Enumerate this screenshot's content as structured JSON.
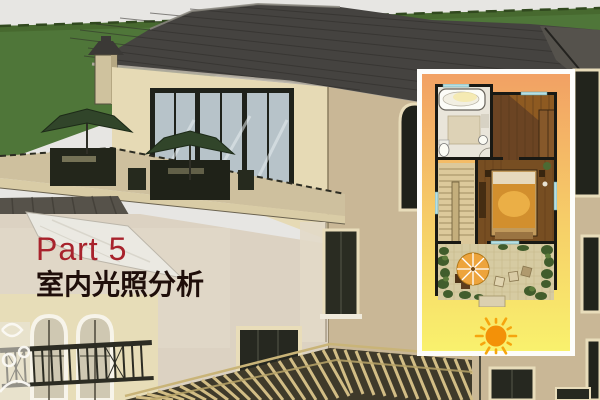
{
  "slide": {
    "part_label": "Part 5",
    "title": "室内光照分析"
  },
  "scene": {
    "description": "3D sketch rendering of a villa exterior",
    "elements": [
      "hillside",
      "hip-roof",
      "chimney",
      "roof-terrace",
      "patio-umbrellas",
      "glass-doors",
      "arched-windows",
      "balcony-railing",
      "pergola"
    ]
  },
  "inset_panel": {
    "content": "floor-plan",
    "rooms": [
      "bathroom",
      "bedroom",
      "staircase",
      "roof-terrace"
    ],
    "icons": [
      "sun-icon",
      "parasol-icon",
      "bathtub-icon",
      "bed-icon"
    ],
    "has_pointer_line": true
  },
  "colors": {
    "accent_red": "#a8222c",
    "title_dark": "#1f0e0a",
    "panel_border": "#fdfdfb",
    "panel_top": "#f2a164",
    "panel_mid": "#f6cf68",
    "panel_bottom": "#f9f16d",
    "sun": "#f39108",
    "sun_ray": "#f6a50e",
    "pointer": "#4f4c3e",
    "hill_green": "#4f7639",
    "roof_gray": "#454340",
    "wall_cream": "#e6dab5",
    "wall_tan": "#c9b796",
    "umbrella_green": "#31452a"
  }
}
